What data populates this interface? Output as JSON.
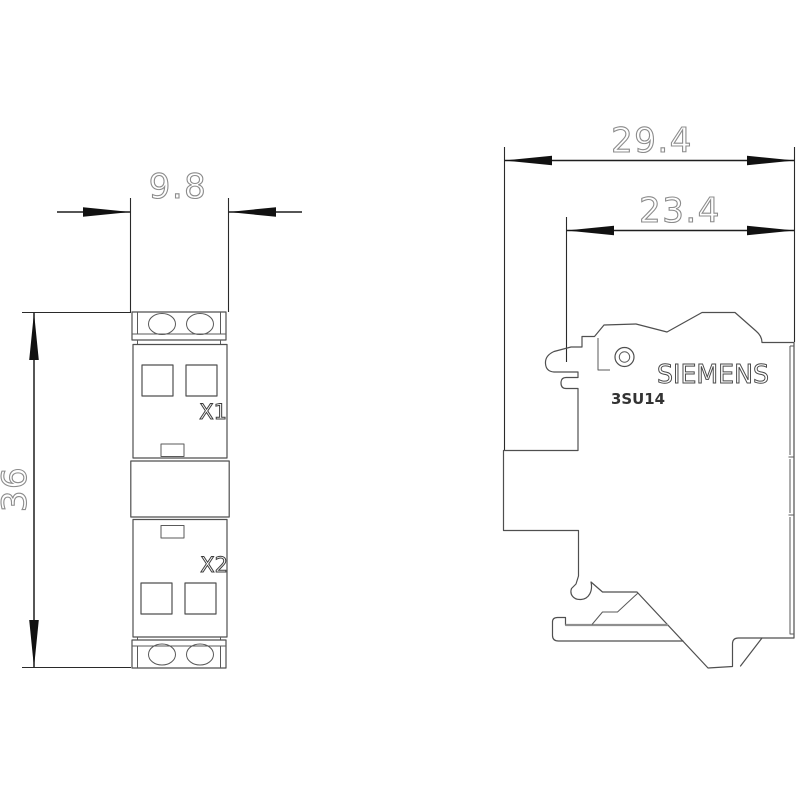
{
  "front_view": {
    "dim_width": "9.8",
    "dim_height": "36",
    "label_x1": "X1",
    "label_x2": "X2"
  },
  "side_view": {
    "dim_overall_depth": "29.4",
    "dim_body_depth": "23.4",
    "brand": "SIEMENS",
    "product_code": "3SU14"
  },
  "colors": {
    "background": "#ffffff",
    "part_outline": "#4f4f4f",
    "dimension_line": "#1f1f1f",
    "dimension_text": "#8c8c8c",
    "clamp_line": "#8f8f8f",
    "label_text": "#3d3d3d"
  }
}
